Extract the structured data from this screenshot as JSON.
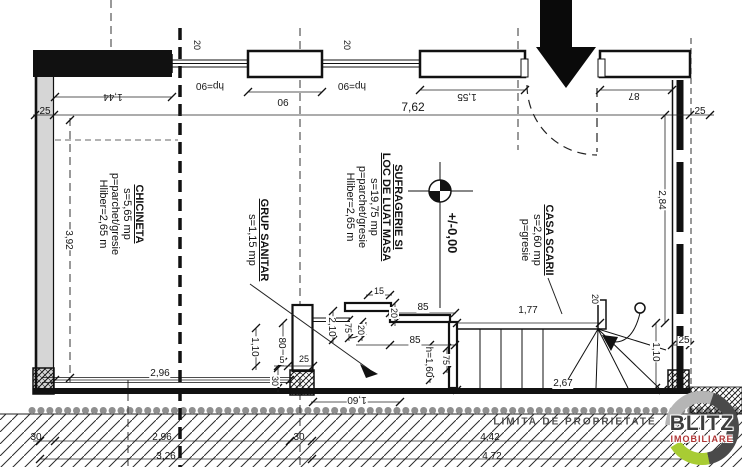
{
  "plan": {
    "level_label": "+/-0,00",
    "property_line_label": "LIMITA DE PROPRIETATE",
    "window_height_label": "hp=90"
  },
  "rooms": {
    "chicineta": [
      "CHICINETA",
      "s=5,65 mp",
      "p=parchet/gresie",
      "Hliber=2,65 m"
    ],
    "sufragerie": [
      "SUFRAGERIE SI",
      "LOC DE LUAT MASA",
      "s=19,75 mp",
      "p=parchet/gresie",
      "Hliber=2,65 m"
    ],
    "grup_sanitar": [
      "GRUP SANITAR",
      "s=1,15 mp"
    ],
    "casa_scarii": [
      "CASA SCARII",
      "s=2,60 mp",
      "p=gresie"
    ]
  },
  "dims": {
    "d25": "25",
    "d144": "1,44",
    "d20": "20",
    "d90": "90",
    "d762": "7,62",
    "d155": "1,55",
    "d87": "87",
    "d284": "2,84",
    "d392": "3,92",
    "d296": "2,96",
    "d326": "3,26",
    "d442": "4,42",
    "d472": "4,72",
    "d30": "30",
    "d110": "1,10",
    "d80": "80",
    "d5": "5",
    "d210": "2,10",
    "d75": "75",
    "d15": "15",
    "d85": "85",
    "dh160": "h=1,60",
    "d160": "1,60",
    "d177": "1,77",
    "d267": "2,67"
  },
  "logo": {
    "line1": "BLITZ",
    "line2": "IMOBILIARE"
  },
  "colors": {
    "line": "#1a1a1a",
    "wall_poche": "#d6d6d6",
    "property_dots": "#8f8f8f",
    "logo_green": "#a8cc33",
    "logo_dark": "#4a4a4a",
    "logo_light": "#b5b5b5",
    "logo_red": "#b03535"
  }
}
